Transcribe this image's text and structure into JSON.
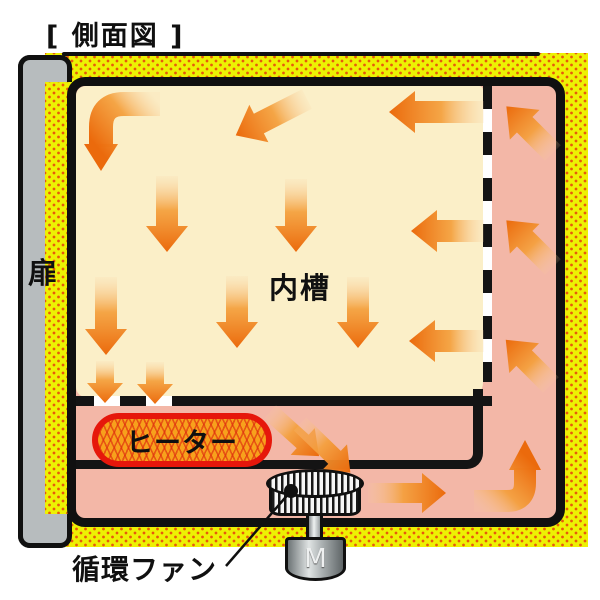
{
  "title": "[ 側面図 ]",
  "labels": {
    "door": "扉",
    "inner_chamber": "内槽",
    "heater": "ヒーター",
    "circulation_fan": "循環ファン",
    "motor": "M"
  },
  "colors": {
    "insulation_yellow": "#edf103",
    "insulation_dot_orange": "#e8590c",
    "air_channel_pink": "#f3b7a7",
    "chamber_cream": "#fbefc8",
    "arrow_orange_head": "#eb6a0c",
    "arrow_orange_mid": "#f49f3b",
    "arrow_orange_tail": "#f9ce9c",
    "heater_fill": "#f7a11c",
    "heater_border_red": "#e6170b",
    "door_gray": "#b7bcbe",
    "outline_black": "#101010"
  },
  "arrows": {
    "straight": [
      {
        "name": "chamber-in-top-right",
        "x": 484,
        "y": 112,
        "angle": 180,
        "len": 95,
        "shaft": 11,
        "headl": 26,
        "headw": 21
      },
      {
        "name": "chamber-in-top-center",
        "x": 307,
        "y": 99,
        "angle": 153,
        "len": 80,
        "shaft": 11,
        "headl": 26,
        "headw": 21
      },
      {
        "name": "chamber-down-1",
        "x": 167,
        "y": 176,
        "angle": 90,
        "len": 76,
        "shaft": 11,
        "headl": 26,
        "headw": 21
      },
      {
        "name": "chamber-down-2",
        "x": 296,
        "y": 179,
        "angle": 90,
        "len": 73,
        "shaft": 11,
        "headl": 26,
        "headw": 21
      },
      {
        "name": "chamber-in-mid-right",
        "x": 484,
        "y": 231,
        "angle": 180,
        "len": 73,
        "shaft": 11,
        "headl": 26,
        "headw": 21
      },
      {
        "name": "chamber-down-3",
        "x": 106,
        "y": 277,
        "angle": 90,
        "len": 78,
        "shaft": 11,
        "headl": 26,
        "headw": 21
      },
      {
        "name": "chamber-down-4",
        "x": 237,
        "y": 276,
        "angle": 90,
        "len": 72,
        "shaft": 11,
        "headl": 26,
        "headw": 21
      },
      {
        "name": "chamber-down-5",
        "x": 358,
        "y": 277,
        "angle": 90,
        "len": 71,
        "shaft": 11,
        "headl": 26,
        "headw": 21
      },
      {
        "name": "chamber-in-low-right",
        "x": 484,
        "y": 341,
        "angle": 180,
        "len": 75,
        "shaft": 11,
        "headl": 26,
        "headw": 21
      },
      {
        "name": "floor-pass-1",
        "x": 105,
        "y": 361,
        "angle": 90,
        "len": 42,
        "shaft": 9,
        "headl": 20,
        "headw": 18
      },
      {
        "name": "floor-pass-2",
        "x": 155,
        "y": 362,
        "angle": 90,
        "len": 42,
        "shaft": 9,
        "headl": 20,
        "headw": 18
      },
      {
        "name": "to-fan-1",
        "x": 270,
        "y": 412,
        "angle": 42,
        "len": 66,
        "shaft": 9,
        "headl": 22,
        "headw": 18
      },
      {
        "name": "to-fan-2",
        "x": 300,
        "y": 424,
        "angle": 44,
        "len": 70,
        "shaft": 9,
        "headl": 22,
        "headw": 18
      },
      {
        "name": "bottom-channel-right",
        "x": 368,
        "y": 493,
        "angle": 0,
        "len": 78,
        "shaft": 10,
        "headl": 24,
        "headw": 20
      },
      {
        "name": "right-channel-up-1",
        "x": 553,
        "y": 153,
        "angle": -135,
        "len": 66,
        "shaft": 11,
        "headl": 26,
        "headw": 21
      },
      {
        "name": "right-channel-up-2",
        "x": 553,
        "y": 267,
        "angle": -135,
        "len": 66,
        "shaft": 11,
        "headl": 26,
        "headw": 21
      },
      {
        "name": "right-channel-up-3",
        "x": 551,
        "y": 385,
        "angle": -135,
        "len": 64,
        "shaft": 11,
        "headl": 26,
        "headw": 21
      }
    ],
    "elbows": [
      {
        "name": "chamber-elbow-topleft",
        "shaft": "M 160 104 L 124 104 Q 101 104 101 127 L 101 147",
        "width": 24,
        "head": "84,144 118,144 101,171",
        "x1": 160,
        "y1": 104,
        "x2": 101,
        "y2": 152
      },
      {
        "name": "channel-elbow-bottomright",
        "shaft": "M 474 501 L 507 501 Q 525 501 525 483 L 525 468",
        "width": 22,
        "head": "509,470 541,470 525,440",
        "x1": 474,
        "y1": 505,
        "x2": 525,
        "y2": 455
      }
    ],
    "callout": {
      "dot_x": 291,
      "dot_y": 491,
      "x2": 226,
      "y2": 566
    }
  }
}
